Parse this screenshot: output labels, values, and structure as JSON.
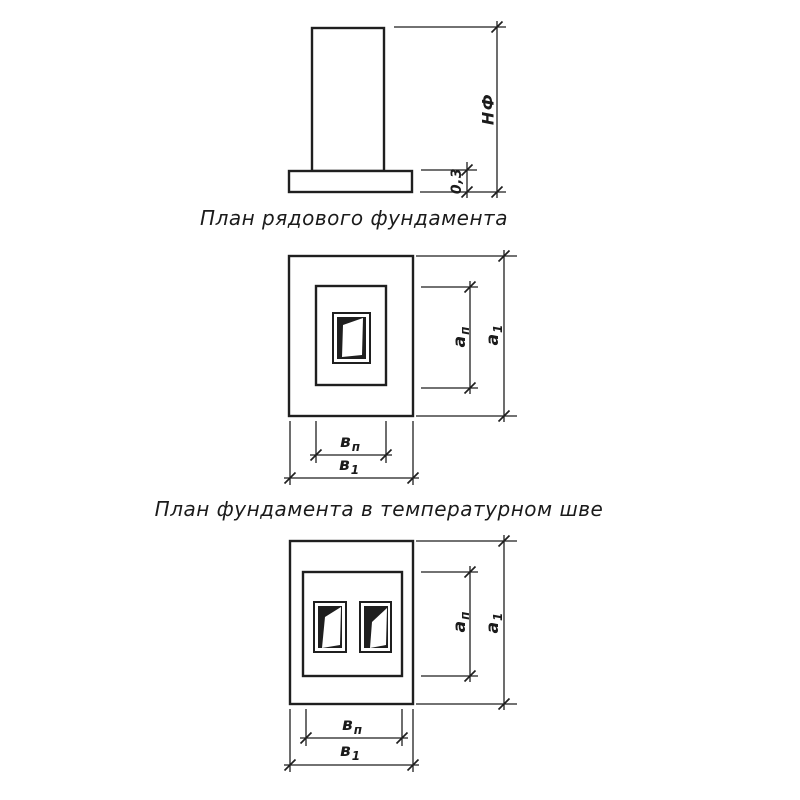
{
  "colors": {
    "ink": "#1f1f1f",
    "paper": "#ffffff"
  },
  "captions": {
    "plan_regular": "План рядового фундамента",
    "plan_expansion": "План фундамента в температурном шве"
  },
  "elevation": {
    "height_label": "НФ",
    "slab_thickness_label": "0,3"
  },
  "dims": {
    "a_inner": {
      "base": "а",
      "sub": "п"
    },
    "a_outer": {
      "base": "а",
      "sub": "1"
    },
    "b_inner": {
      "base": "в",
      "sub": "п"
    },
    "b_outer": {
      "base": "в",
      "sub": "1"
    }
  }
}
